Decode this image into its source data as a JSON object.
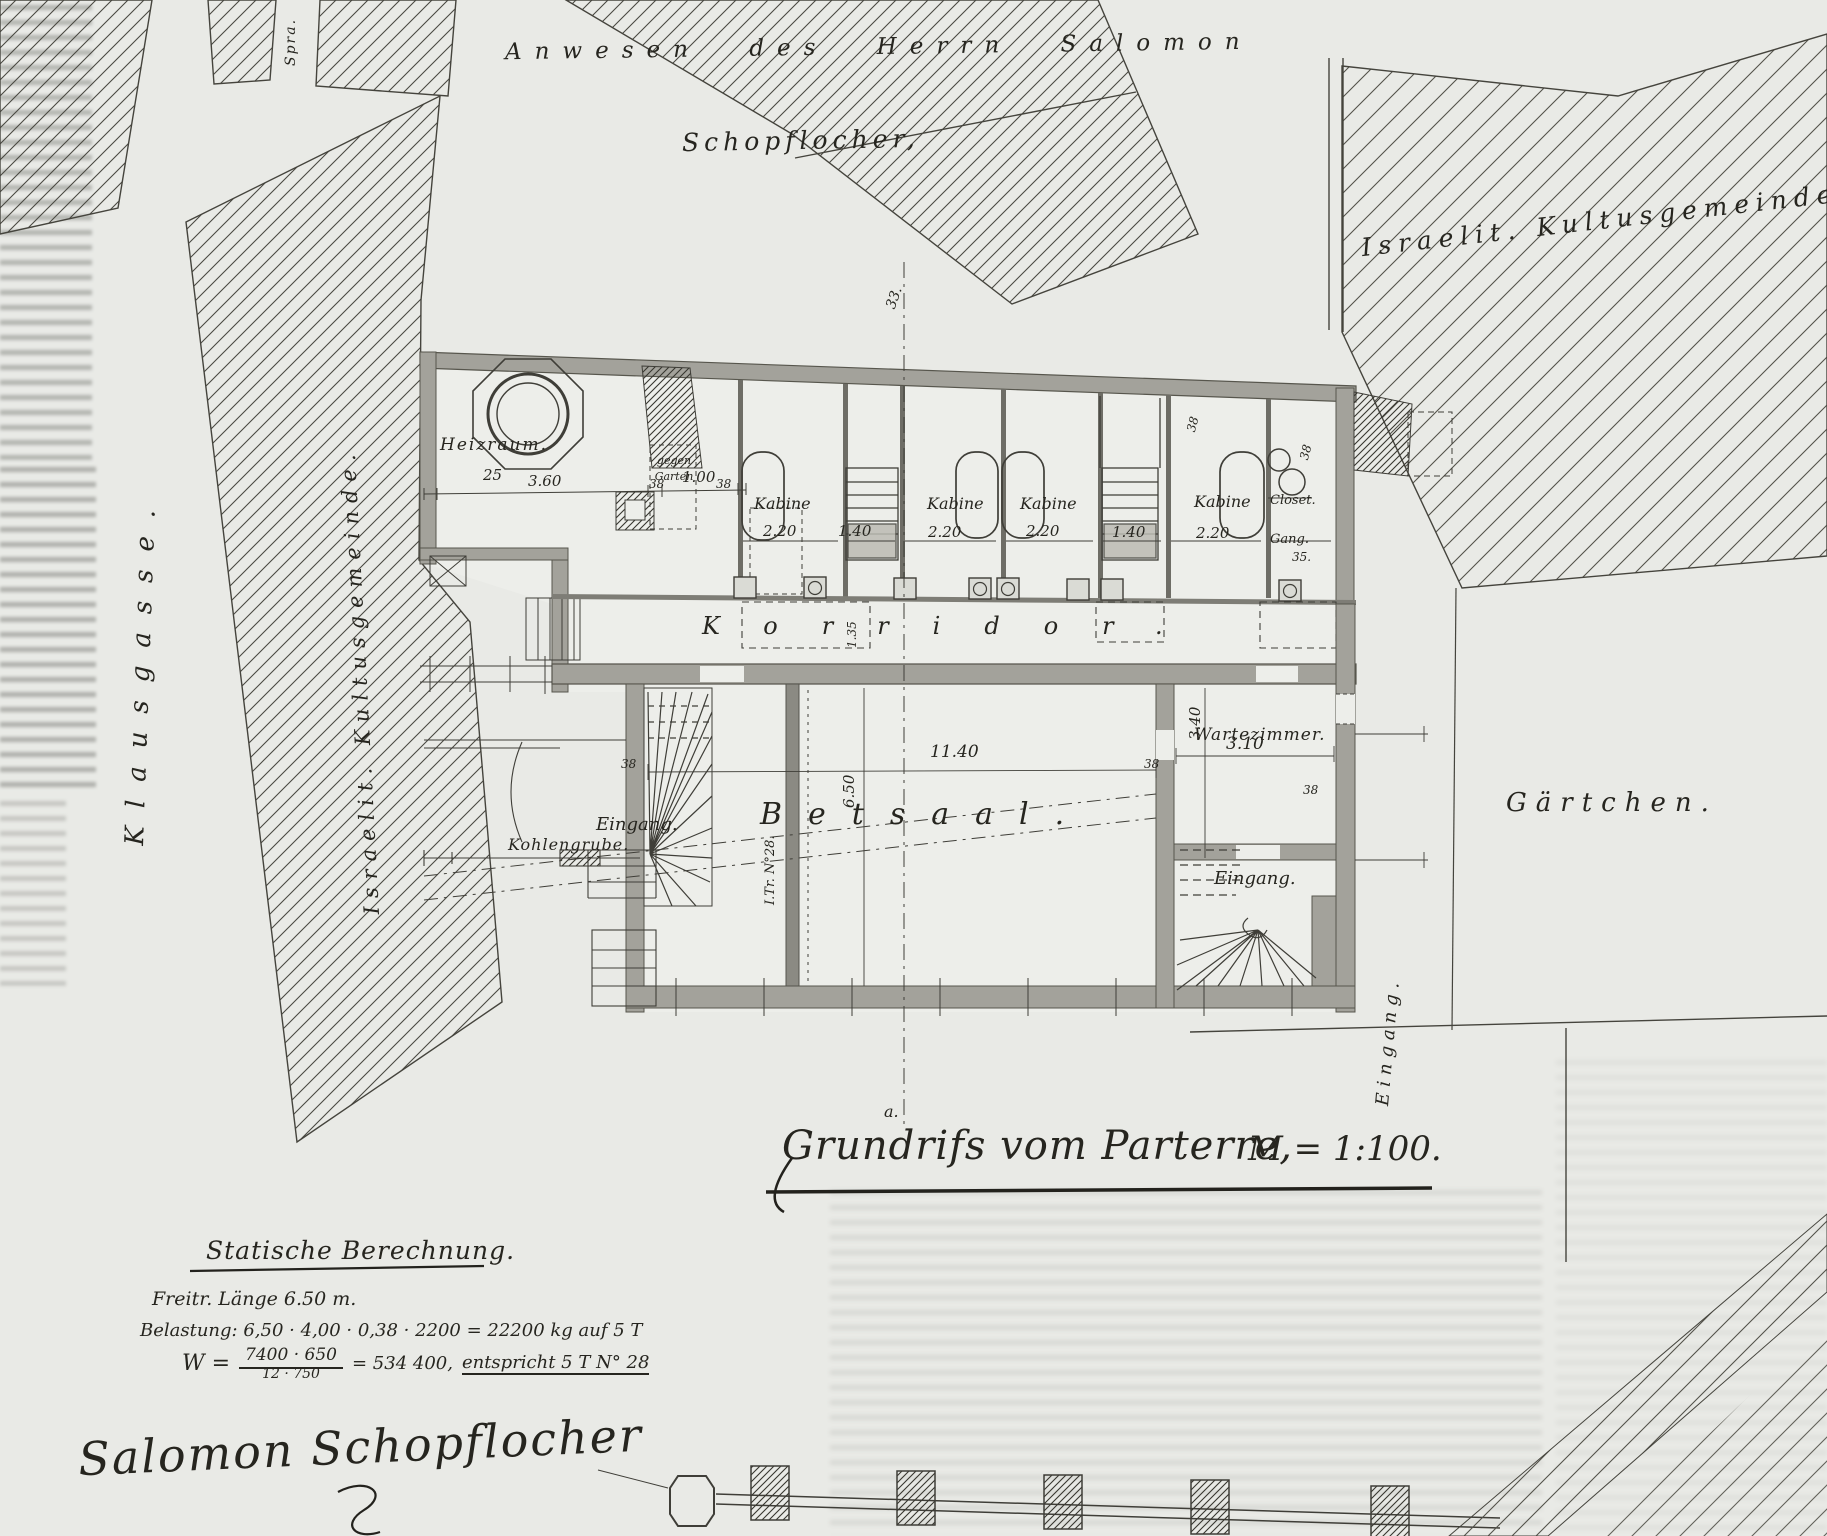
{
  "surroundings": {
    "anwesen": "Anwesen des Herrn Salomon",
    "schopflocher": "Schopflocher,",
    "kultus_right": "Israelit. Kultusgemeinde",
    "kultus_left": "Israelit. Kultusgemeinde.",
    "klausgasse": "Klausgasse.",
    "spra": "Spra.",
    "gaertchen": "Gärtchen."
  },
  "plan": {
    "rooms": {
      "heizraum": "Heizraum.",
      "gegen1": "gegen",
      "gegen2": "Garten",
      "kabine1": "Kabine",
      "kabine2": "Kabine",
      "kabine3": "Kabine",
      "kabine4": "Kabine",
      "closet": "Closet.",
      "gang": "Gang.",
      "korridor": "Korridor.",
      "kohlengrube": "Kohlengrube.",
      "eingang_left": "Eingang.",
      "betsaal": "Betsaal.",
      "wartezimmer": "Wartezimmer.",
      "eingang_right": "Eingang.",
      "eingang_side": "Eingang."
    },
    "dims": [
      {
        "t": "25"
      },
      {
        "t": "3.60"
      },
      {
        "t": "38"
      },
      {
        "t": "1.00"
      },
      {
        "t": "38"
      },
      {
        "t": "2.20"
      },
      {
        "t": "1.40"
      },
      {
        "t": "2.20"
      },
      {
        "t": "2.20"
      },
      {
        "t": "1.40"
      },
      {
        "t": "2.20"
      },
      {
        "t": "38"
      },
      {
        "t": "38"
      },
      {
        "t": "38"
      },
      {
        "t": "11.40"
      },
      {
        "t": "6.50"
      },
      {
        "t": "3.40"
      },
      {
        "t": "3.10"
      },
      {
        "t": "38"
      },
      {
        "t": "38"
      },
      {
        "t": "1.35"
      },
      {
        "t": "33."
      },
      {
        "t": "a."
      },
      {
        "t": "35."
      }
    ],
    "annotations": {
      "girder": "I.Tr. N°28."
    }
  },
  "title": {
    "text": "Grundrifs vom Parterre,",
    "scale": "M = 1:100."
  },
  "statics": {
    "heading": "Statische Berechnung.",
    "line1": "Freitr. Länge 6.50 m.",
    "line2": "Belastung: 6,50 · 4,00 · 0,38 · 2200 = 22200 kg auf 5 T",
    "w": "W =",
    "num": "7400 · 650",
    "den": "12 · 750",
    "eq": "= 534 400,",
    "result": "entspricht 5 T N° 28"
  },
  "signature": "Salomon Schopflocher"
}
